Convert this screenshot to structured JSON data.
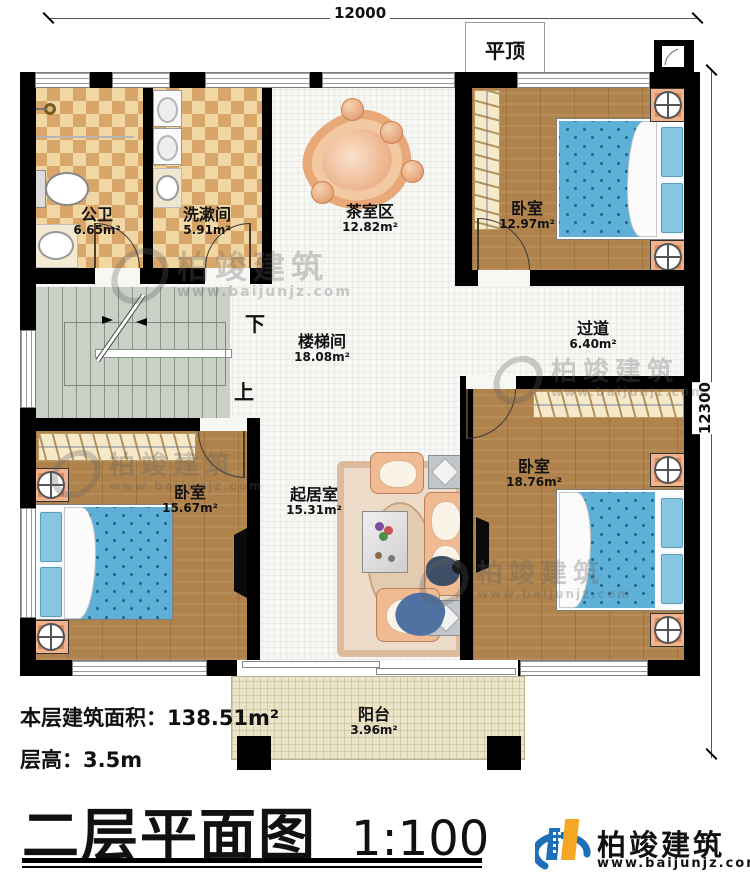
{
  "dimensions": {
    "top": "12000",
    "right": "12300"
  },
  "roof_label": "平顶",
  "stairs": {
    "down": "下",
    "up": "上"
  },
  "rooms": [
    {
      "id": "public-bathroom",
      "name": "公卫",
      "area": "6.65m²"
    },
    {
      "id": "washroom",
      "name": "洗漱间",
      "area": "5.91m²"
    },
    {
      "id": "tea-area",
      "name": "茶室区",
      "area": "12.82m²"
    },
    {
      "id": "bedroom-top-right",
      "name": "卧室",
      "area": "12.97m²"
    },
    {
      "id": "stair-hall",
      "name": "楼梯间",
      "area": "18.08m²"
    },
    {
      "id": "hallway",
      "name": "过道",
      "area": "6.40m²"
    },
    {
      "id": "bedroom-bottom-left",
      "name": "卧室",
      "area": "15.67m²"
    },
    {
      "id": "living-room",
      "name": "起居室",
      "area": "15.31m²"
    },
    {
      "id": "bedroom-bottom-right",
      "name": "卧室",
      "area": "18.76m²"
    },
    {
      "id": "balcony",
      "name": "阳台",
      "area": "3.96m²"
    }
  ],
  "info": {
    "floor_area_label": "本层建筑面积：",
    "floor_area_value": "138.51m²",
    "floor_height_label": "层高：",
    "floor_height_value": "3.5m"
  },
  "title": {
    "text": "二层平面图",
    "scale": "1:100"
  },
  "brand": {
    "name": "柏竣建筑",
    "website": "www.baijunjz.com"
  },
  "colors": {
    "wall": "#000000",
    "wood_floor": "#b0834c",
    "tile_dark": "#d9a66a",
    "tile_light": "#f0d7a4",
    "bed": "#5fb0d6",
    "stairs": "#c9d1c6",
    "balcony": "#ece4c9",
    "brand_blue": "#1d70b7",
    "brand_orange": "#f5a623"
  }
}
